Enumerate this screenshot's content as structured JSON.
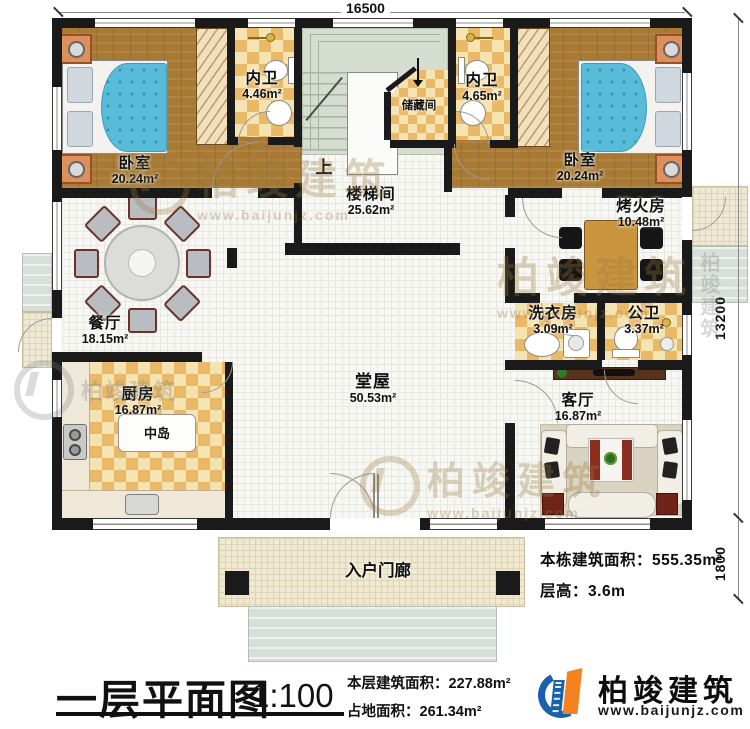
{
  "dimensions": {
    "top": "16500",
    "right": "13200",
    "porch": "1800"
  },
  "rooms": {
    "bedroom_left": {
      "name": "卧室",
      "area": "20.24m²"
    },
    "bath_left": {
      "name": "内卫",
      "area": "4.46m²"
    },
    "storage": {
      "name": "储藏间"
    },
    "stairwell": {
      "name": "楼梯间",
      "area": "25.62m²",
      "up": "上"
    },
    "bath_right": {
      "name": "内卫",
      "area": "4.65m²"
    },
    "bedroom_right": {
      "name": "卧室",
      "area": "20.24m²"
    },
    "fire_room": {
      "name": "烤火房",
      "area": "10.48m²"
    },
    "dining": {
      "name": "餐厅",
      "area": "18.15m²"
    },
    "laundry": {
      "name": "洗衣房",
      "area": "3.09m²"
    },
    "toilet": {
      "name": "公卫",
      "area": "3.37m²"
    },
    "kitchen": {
      "name": "厨房",
      "area": "16.87m²",
      "island": "中岛"
    },
    "hall": {
      "name": "堂屋",
      "area": "50.53m²"
    },
    "living": {
      "name": "客厅",
      "area": "16.87m²"
    },
    "porch": {
      "name": "入户门廊"
    }
  },
  "info": {
    "building_area_label": "本栋建筑面积：",
    "building_area_value": "555.35m²",
    "floor_height_label": "层高：",
    "floor_height_value": "3.6m"
  },
  "footer": {
    "title": "一层平面图",
    "scale": "1:100",
    "floor_area_label": "本层建筑面积：",
    "floor_area_value": "227.88m²",
    "footprint_label": "占地面积：",
    "footprint_value": "261.34m²"
  },
  "brand": {
    "name": "柏竣建筑",
    "url": "www.baijunjz.com"
  },
  "watermark": {
    "text": "柏竣建筑",
    "url": "www.baijunjz.com"
  },
  "colors": {
    "wall": "#1a1a1a",
    "wood": "#a87a34",
    "checker_light": "#f6e3b2",
    "checker_dark": "#e9b968",
    "stair": "#d5ddd0",
    "brand_blue": "#1961ac",
    "brand_orange": "#f5821f"
  }
}
